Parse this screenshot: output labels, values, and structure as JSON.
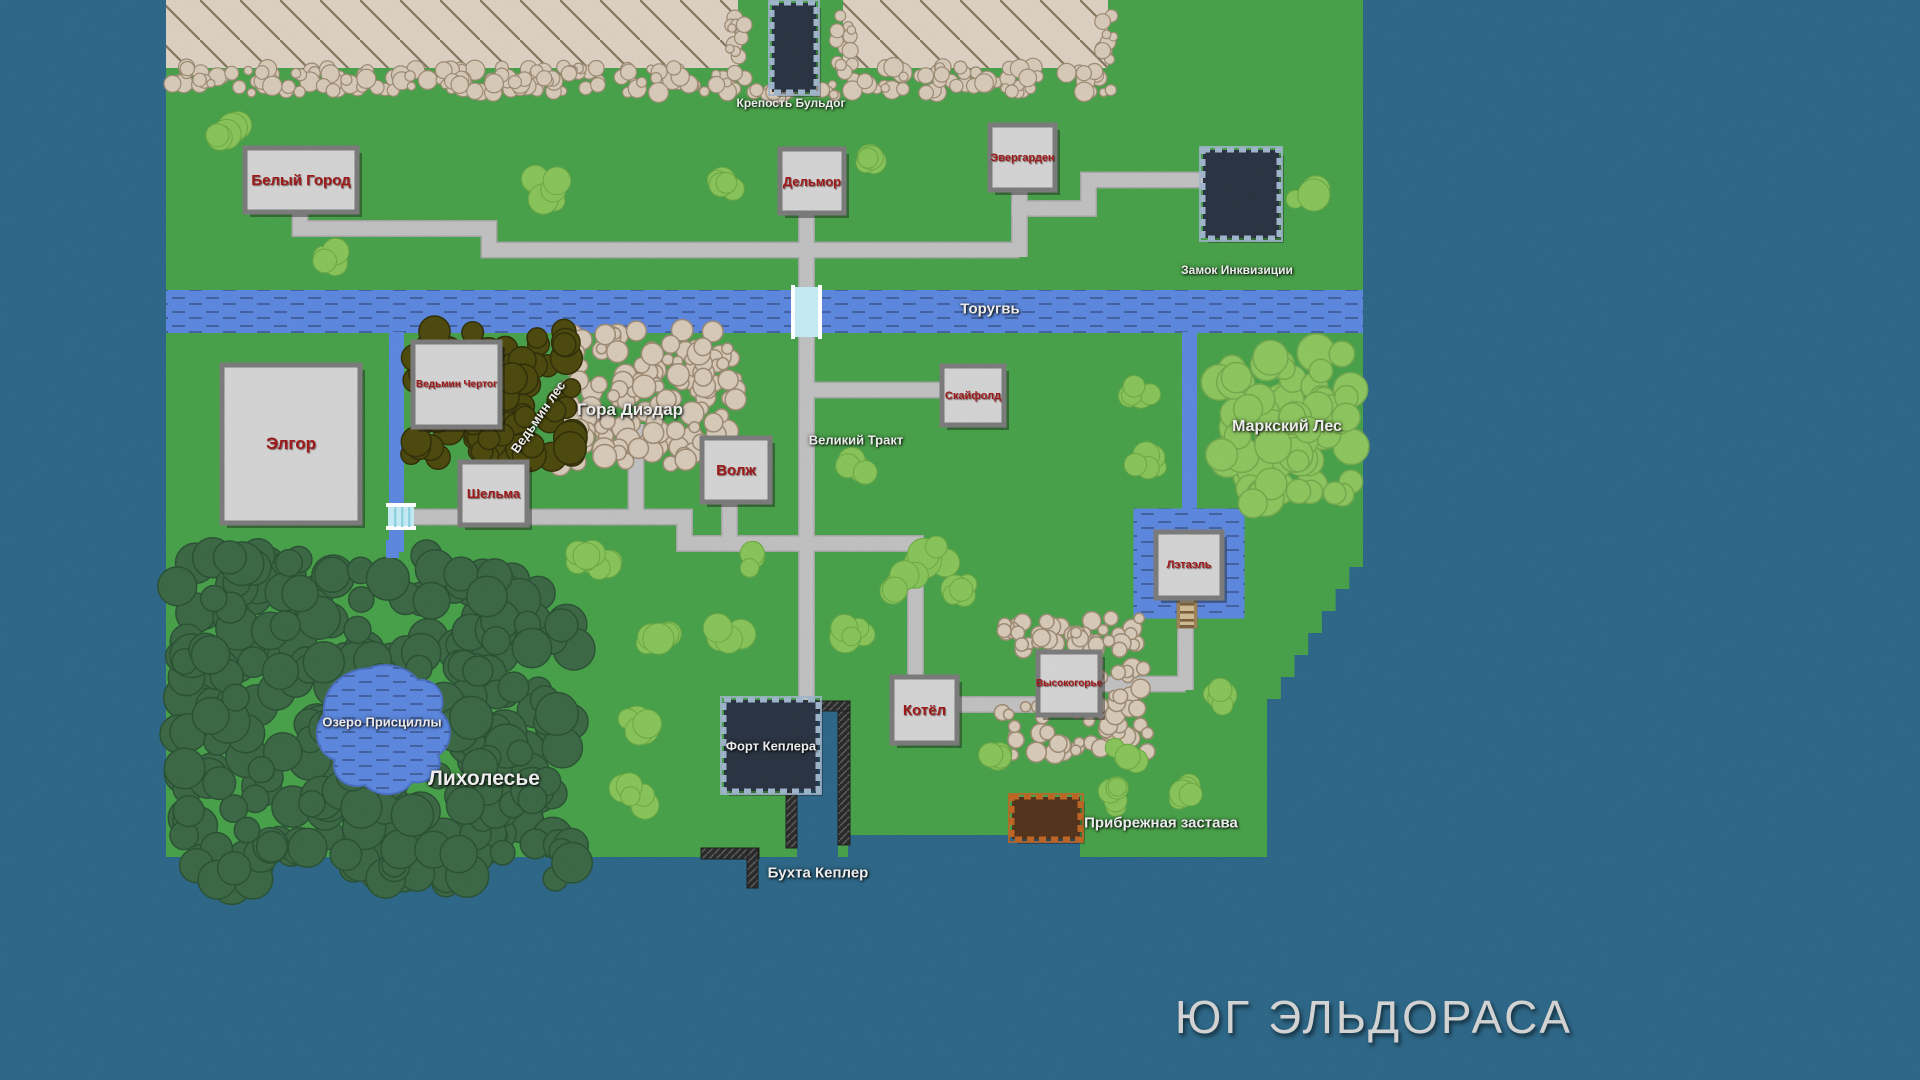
{
  "map": {
    "title": "ЮГ ЭЛЬДОРАСА",
    "colors": {
      "ocean": "#2E6787",
      "grass": "#49A04A",
      "bush": "#87C35A",
      "bush_edge": "#6CA746",
      "road": "#BFBFBF",
      "road_edge": "#A5A5A5",
      "river": "#5C87DC",
      "river_dash": "#44629F",
      "forest_dark": "#3D6845",
      "forest_dark_edge": "#2C5236",
      "forest_light": "#8CC45F",
      "forest_light_edge": "#74A84E",
      "forest_olive": "#4D4A0F",
      "forest_olive_edge": "#31300A",
      "rock": "#D5C8B6",
      "rock_edge": "#9C8A74",
      "plateau": "#DACFC0",
      "plateau_line": "#85755F",
      "wall": "#2B2B2B",
      "wall_line": "#5E5E5E",
      "box_fill": "#D2D2D2",
      "box_border": "#7B7B7B",
      "box_label": "#9E1A1A",
      "castle_fill": "#2A3442",
      "castle_border": "#9FB4CA",
      "outpost_fill": "#55341D",
      "outpost_border": "#BF6526",
      "bridge": "#C3E9F2",
      "ladder": "#CDBA93"
    },
    "settlements": [
      {
        "id": "belyi-gorod",
        "label": "Белый Город"
      },
      {
        "id": "delmor",
        "label": "Дельмор"
      },
      {
        "id": "evergarden",
        "label": "Эвергарден"
      },
      {
        "id": "elgor",
        "label": "Элгор"
      },
      {
        "id": "vedmin-chertog",
        "label": "Ведьмин Чертог"
      },
      {
        "id": "shelma",
        "label": "Шельма"
      },
      {
        "id": "volzh",
        "label": "Волж"
      },
      {
        "id": "skyfold",
        "label": "Скайфолд"
      },
      {
        "id": "letael",
        "label": "Лэтаэль"
      },
      {
        "id": "kotel",
        "label": "Котёл"
      },
      {
        "id": "vysokogorye",
        "label": "Высокогорье"
      }
    ],
    "castles": [
      {
        "id": "krepost-buldog",
        "label": "Крепость Бульдог"
      },
      {
        "id": "zamok-inkvizicii",
        "label": "Замок Инквизиции"
      },
      {
        "id": "fort-keplera",
        "label": "Форт Кеплера"
      },
      {
        "id": "pribrezhnaya-zastava",
        "label": "Прибрежная застава"
      }
    ],
    "regions": [
      {
        "id": "torugv",
        "label": "Торугвь"
      },
      {
        "id": "vedmin-les",
        "label": "Ведьмин лес"
      },
      {
        "id": "gora-diezdar",
        "label": "Гора Диэдар"
      },
      {
        "id": "velikiy-trakt",
        "label": "Великий Тракт"
      },
      {
        "id": "markskiy-les",
        "label": "Маркский Лес"
      },
      {
        "id": "ozero-priscilly",
        "label": "Озеро Присциллы"
      },
      {
        "id": "likholesye",
        "label": "Лихолесье"
      },
      {
        "id": "bukhta-kepler",
        "label": "Бухта Кеплер"
      }
    ]
  }
}
